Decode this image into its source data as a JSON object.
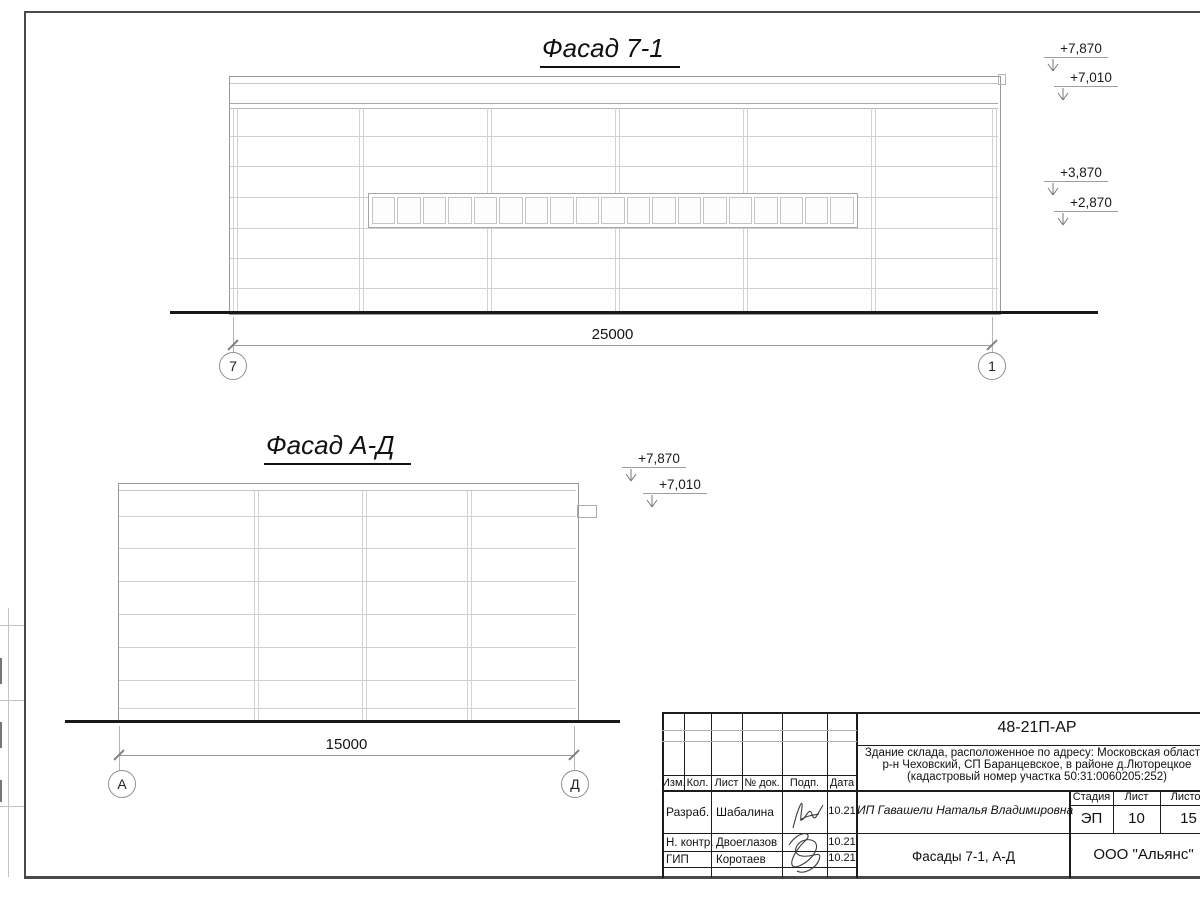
{
  "drawing": {
    "facade1": {
      "title": "Фасад 7-1",
      "dimension": "25000",
      "axis_left": "7",
      "axis_right": "1",
      "window_panes": 19,
      "elevations": {
        "e1": "+7,870",
        "e2": "+7,010",
        "e3": "+3,870",
        "e4": "+2,870"
      }
    },
    "facade2": {
      "title": "Фасад А-Д",
      "dimension": "15000",
      "axis_left": "А",
      "axis_right": "Д",
      "elevations": {
        "e1": "+7,870",
        "e2": "+7,010"
      }
    }
  },
  "title_block": {
    "doc_code": "48-21П-АР",
    "project_description_line1": "Здание склада, расположенное по адресу: Московская область,",
    "project_description_line2": "р-н Чеховский, СП Баранцевское, в районе д.Люторецкое",
    "project_description_line3": "(кадастровый номер участка 50:31:0060205:252)",
    "header_cols": {
      "izm": "Изм.",
      "kol": "Кол.",
      "list": "Лист",
      "doc": "№ док.",
      "podp": "Подп.",
      "data": "Дата"
    },
    "roles": {
      "r1": {
        "role": "Разраб.",
        "name": "Шабалина",
        "date": "10.21"
      },
      "r2": {
        "role": "Н. контр.",
        "name": "Двоеглазов",
        "date": "10.21"
      },
      "r3": {
        "role": "ГИП",
        "name": "Коротаев",
        "date": "10.21"
      }
    },
    "client": "ИП Гавашели Наталья Владимировна",
    "stage_label": "Стадия",
    "sheet_label": "Лист",
    "sheets_label": "Листов",
    "stage": "ЭП",
    "sheet": "10",
    "sheets": "15",
    "sheet_title": "Фасады 7-1, А-Д",
    "company": "ООО \"Альянс\""
  }
}
